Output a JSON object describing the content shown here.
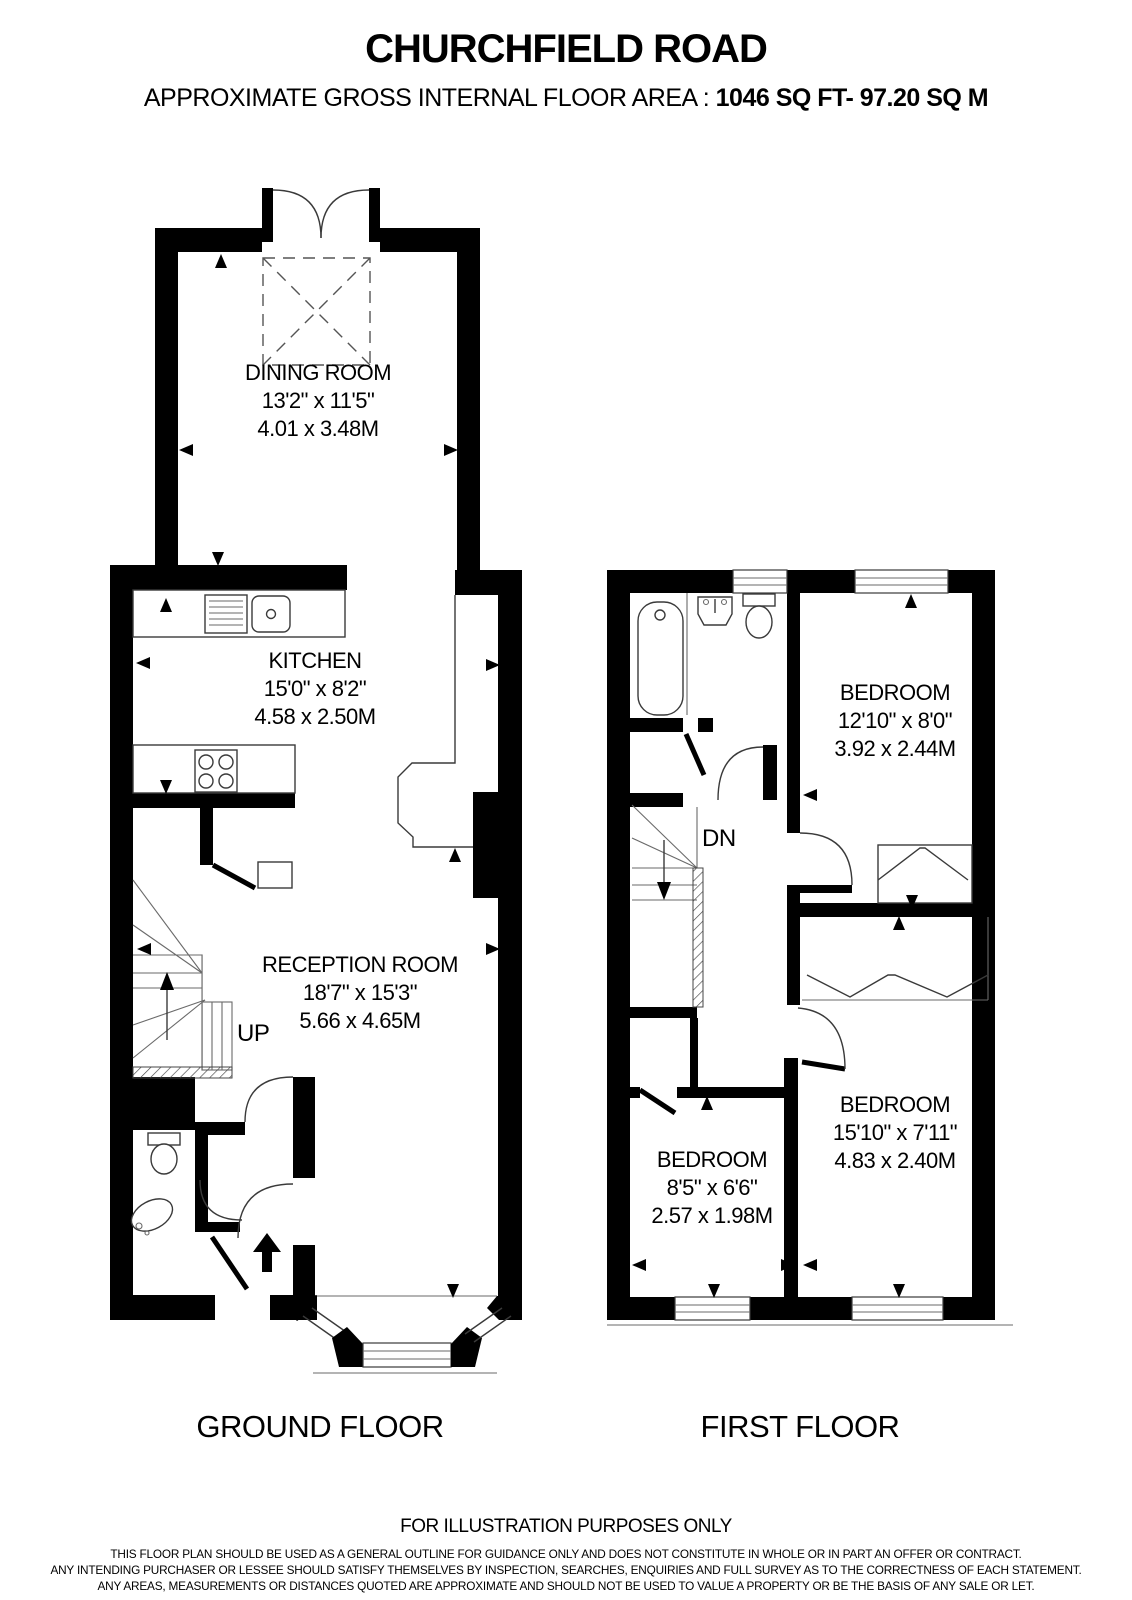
{
  "header": {
    "title": "CHURCHFIELD ROAD",
    "area_label": "APPROXIMATE GROSS INTERNAL FLOOR AREA : ",
    "area_value": "1046 SQ FT- 97.20 SQ M"
  },
  "floors": [
    {
      "name": "GROUND FLOOR",
      "stairs_label": "UP",
      "rooms": [
        {
          "name": "DINING ROOM",
          "dims_imperial": "13'2\" x 11'5\"",
          "dims_metric": "4.01 x 3.48M"
        },
        {
          "name": "KITCHEN",
          "dims_imperial": "15'0\" x 8'2\"",
          "dims_metric": "4.58 x 2.50M"
        },
        {
          "name": "RECEPTION ROOM",
          "dims_imperial": "18'7\" x 15'3\"",
          "dims_metric": "5.66 x 4.65M"
        }
      ]
    },
    {
      "name": "FIRST FLOOR",
      "stairs_label": "DN",
      "rooms": [
        {
          "name": "BEDROOM",
          "dims_imperial": "12'10\" x 8'0\"",
          "dims_metric": "3.92 x 2.44M"
        },
        {
          "name": "BEDROOM",
          "dims_imperial": "8'5\" x 6'6\"",
          "dims_metric": "2.57 x 1.98M"
        },
        {
          "name": "BEDROOM",
          "dims_imperial": "15'10\" x 7'11\"",
          "dims_metric": "4.83 x 2.40M"
        }
      ]
    }
  ],
  "footer": {
    "notice": "FOR ILLUSTRATION PURPOSES ONLY",
    "disclaimer_lines": [
      "THIS FLOOR PLAN SHOULD BE USED AS A GENERAL OUTLINE FOR GUIDANCE ONLY AND DOES NOT CONSTITUTE IN WHOLE OR IN PART AN OFFER OR CONTRACT.",
      "ANY INTENDING PURCHASER OR LESSEE SHOULD SATISFY THEMSELVES BY INSPECTION, SEARCHES, ENQUIRIES AND FULL SURVEY AS TO THE CORRECTNESS OF EACH STATEMENT.",
      "ANY AREAS, MEASUREMENTS OR DISTANCES QUOTED ARE APPROXIMATE AND SHOULD NOT BE USED TO VALUE A PROPERTY OR BE THE BASIS OF ANY SALE OR LET."
    ]
  },
  "colors": {
    "wall": "#000000",
    "line": "#3a3a3a",
    "background": "#ffffff"
  }
}
